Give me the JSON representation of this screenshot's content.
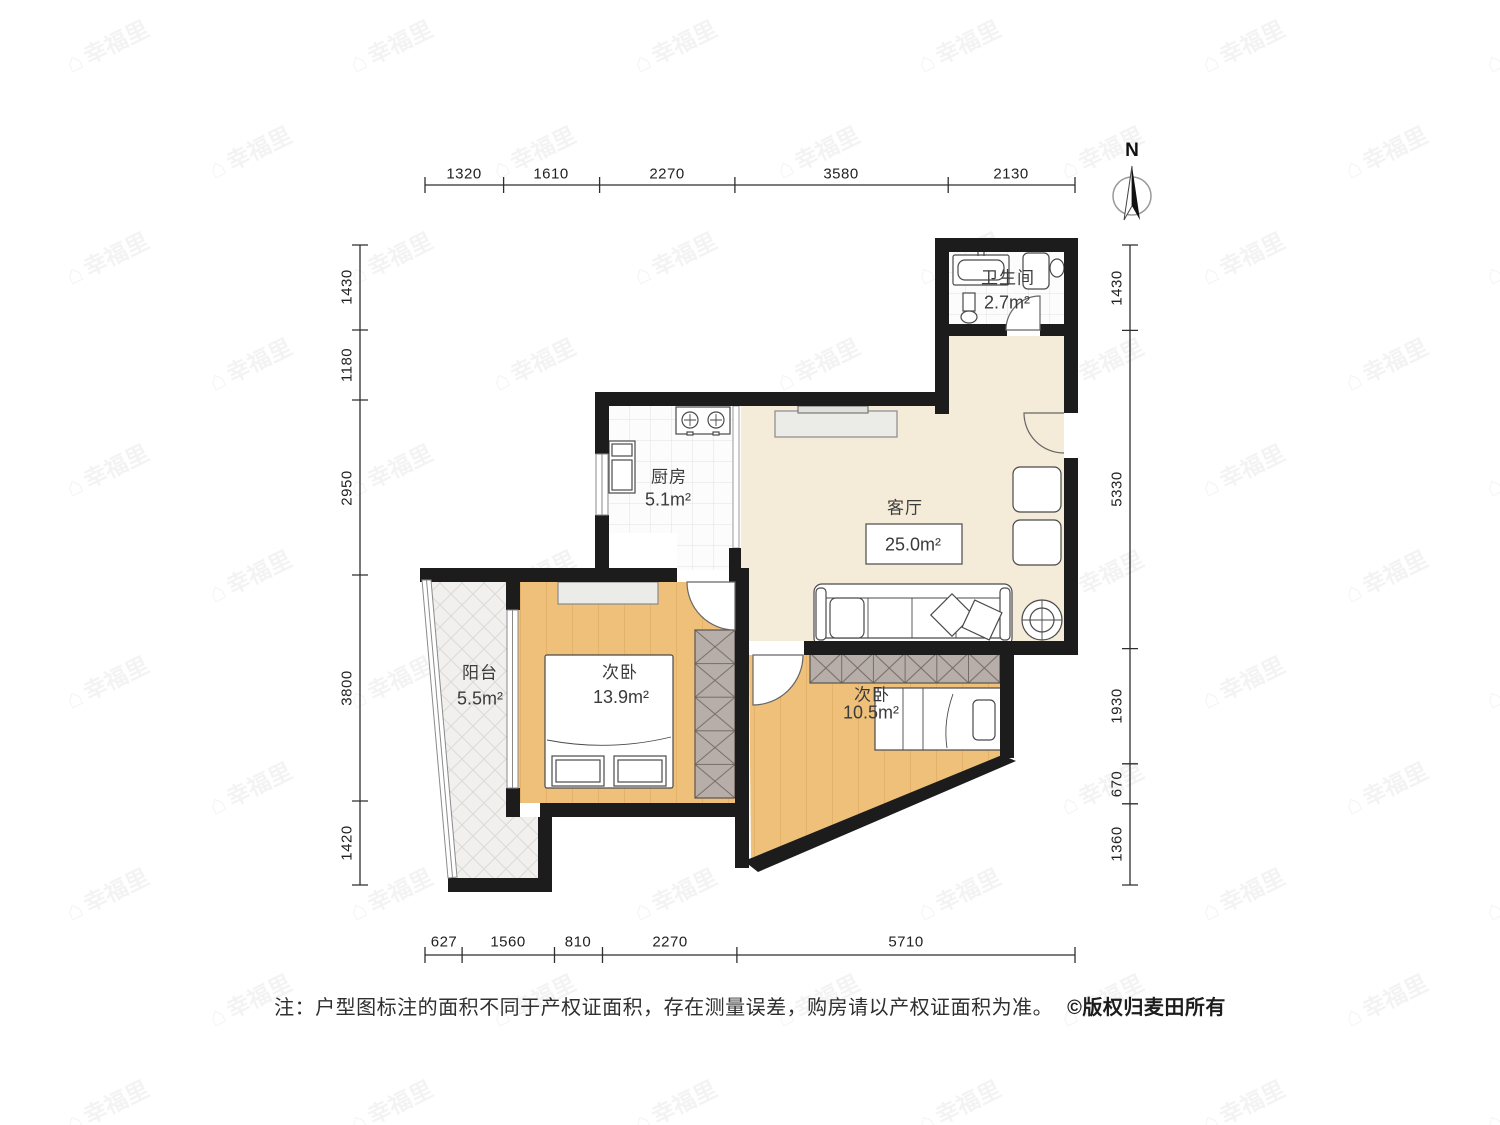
{
  "north": {
    "label": "N"
  },
  "rooms": [
    {
      "name": "卫生间",
      "area": "2.7m²"
    },
    {
      "name": "厨房",
      "area": "5.1m²"
    },
    {
      "name": "客厅",
      "area": "25.0m²"
    },
    {
      "name": "次卧",
      "area": "13.9m²"
    },
    {
      "name": "次卧",
      "area": "10.5m²"
    },
    {
      "name": "阳台",
      "area": "5.5m²"
    }
  ],
  "dimensions": {
    "top": [
      "1320",
      "1610",
      "2270",
      "3580",
      "2130"
    ],
    "left": [
      "1430",
      "1180",
      "2950",
      "3800",
      "1420"
    ],
    "right": [
      "1430",
      "5330",
      "1930",
      "670",
      "1360"
    ],
    "bottom": [
      "627",
      "1560",
      "810",
      "2270",
      "5710"
    ]
  },
  "note": {
    "text": "注：户型图标注的面积不同于产权证面积，存在测量误差，购房请以产权证面积为准。",
    "copyright": "©版权归麦田所有"
  },
  "watermark": {
    "text": "幸福里"
  },
  "colors": {
    "wall": "#1c1c1c",
    "floor_living": "#f4ebd9",
    "floor_wood": "#efc07a",
    "wardrobe": "#b7aea9",
    "tile": "#fcfcfc",
    "lattice": "#f1f0ee"
  }
}
